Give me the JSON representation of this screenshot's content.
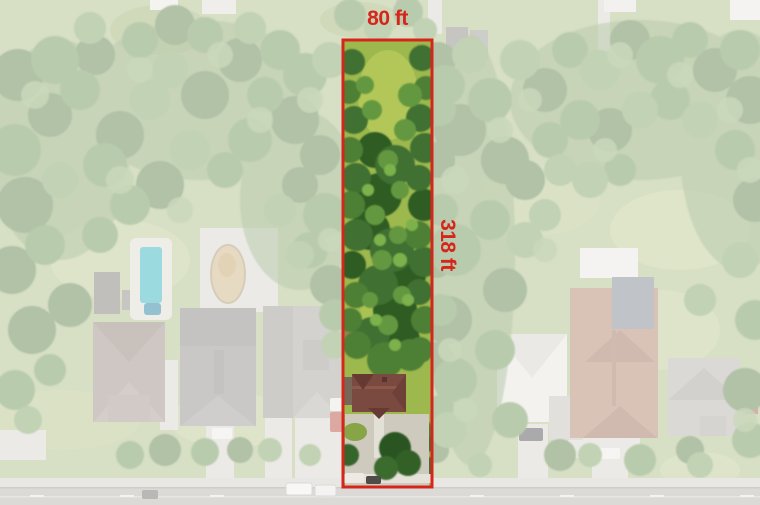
{
  "annotation": {
    "width_label": "80 ft",
    "depth_label": "318 ft"
  },
  "colors": {
    "boundary_red": "#d6261c",
    "pool_turquoise": "#2eb4bd",
    "lot_canopy_green": "#3f7030",
    "lot_roof_brown": "#7a4a40"
  }
}
